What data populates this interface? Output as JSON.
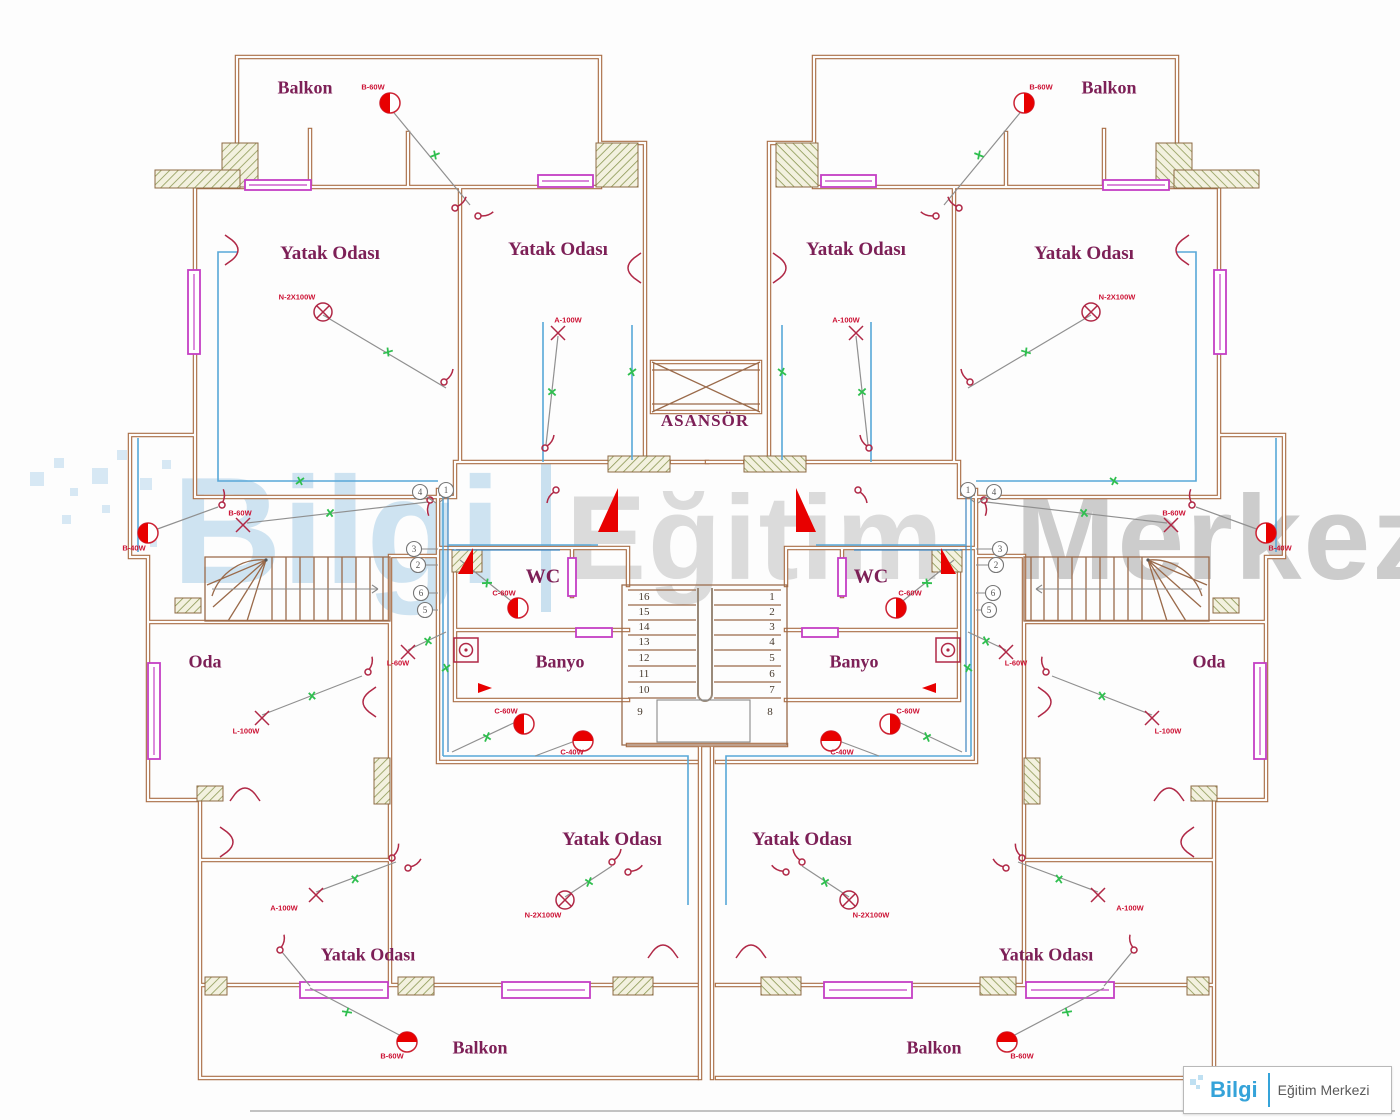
{
  "colors": {
    "wall": "#a96e46",
    "window": "#c43fc4",
    "wire": "#58a8d8",
    "switch_line": "#909090",
    "tick_green": "#2fbf4f",
    "symbol_red": "#e80000",
    "symbol_outline": "#b02846",
    "room_label": "#7d2057",
    "lamp_label": "#cc1133",
    "watermark_blue": "#a7cee8",
    "watermark_gray": "#b9b9b9",
    "logo_blue": "#35a3d9"
  },
  "watermark": {
    "brand": "Bilgi",
    "divider": "|",
    "word1": "Eğitim",
    "word2": "Merkezi"
  },
  "logo": {
    "brand": "Bilgi",
    "name": "Eğitim Merkezi"
  },
  "rooms": {
    "balcony": "Balkon",
    "bedroom": "Yatak Odası",
    "elevator": "ASANSÖR",
    "wc": "WC",
    "bath": "Banyo",
    "room": "Oda"
  },
  "stairs": {
    "left": [
      "16",
      "15",
      "14",
      "13",
      "12",
      "11",
      "10",
      "9"
    ],
    "right": [
      "1",
      "2",
      "3",
      "4",
      "5",
      "6",
      "7",
      "8"
    ]
  },
  "circles": {
    "lp": [
      "4",
      "1"
    ],
    "lc": [
      "3",
      "2",
      "6",
      "5"
    ],
    "rp": [
      "1",
      "4"
    ],
    "rc": [
      "3",
      "2",
      "6",
      "5"
    ]
  },
  "lamps": {
    "balcony": "B-60W",
    "bedroom": "N-2X100W",
    "hall": "B-60W",
    "hall2": "B-40W",
    "wc": "C-60W",
    "bath": "C-40W",
    "room": "L-100W",
    "room_small": "L-60W",
    "aux": "A-100W"
  }
}
